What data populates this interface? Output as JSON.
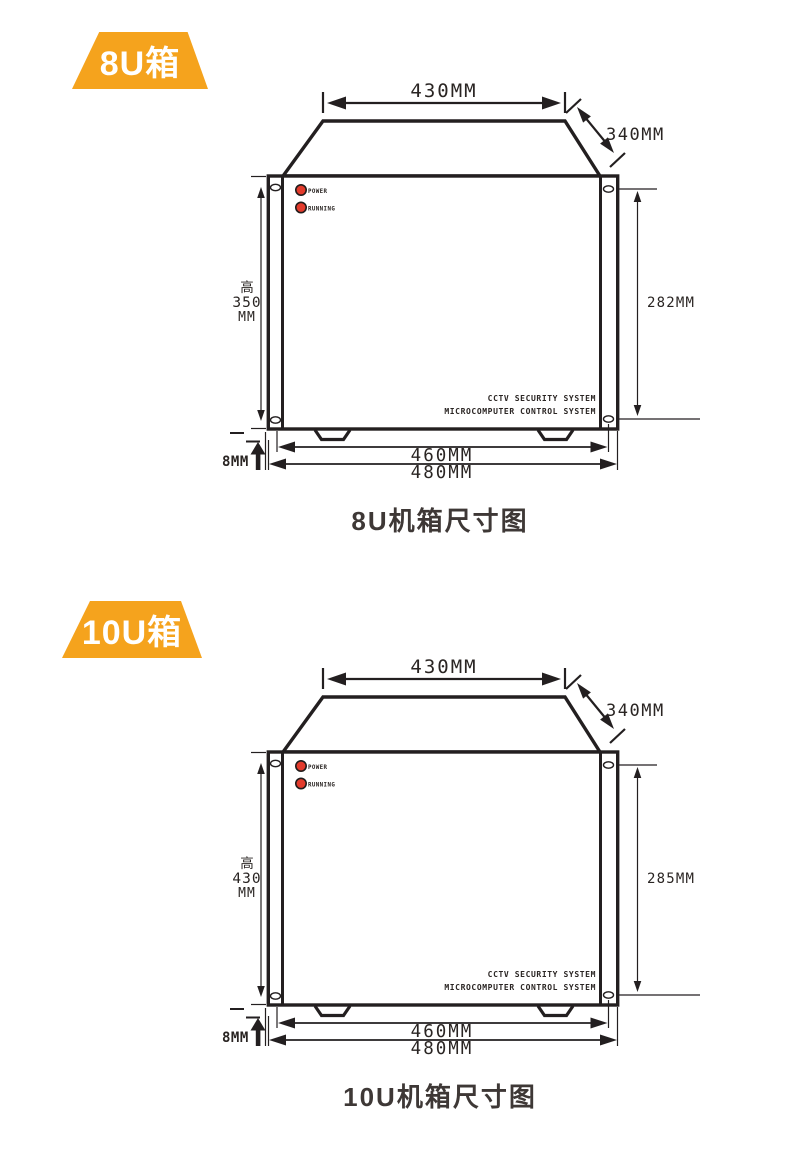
{
  "page": {
    "background": "#ffffff"
  },
  "colors": {
    "badge_bg": "#F5A31D",
    "badge_text": "#FFFFFF",
    "line": "#231F20",
    "led_red": "#E33B2C",
    "dim_text": "#2A2523",
    "caption_text": "#3E3836"
  },
  "diagrams": [
    {
      "badge": "8U箱",
      "dims": {
        "top_width": "430MM",
        "depth": "340MM",
        "height_cn": "高",
        "height_value": "350",
        "height_unit": "MM",
        "panel_height": "282MM",
        "body_width": "460MM",
        "overall_width": "480MM",
        "foot_height": "8MM"
      },
      "panel": {
        "led_power": "POWER",
        "led_running": "RUNNING",
        "brand_line1": "CCTV SECURITY SYSTEM",
        "brand_line2": "MICROCOMPUTER CONTROL SYSTEM"
      },
      "caption": "8U机箱尺寸图"
    },
    {
      "badge": "10U箱",
      "dims": {
        "top_width": "430MM",
        "depth": "340MM",
        "height_cn": "高",
        "height_value": "430",
        "height_unit": "MM",
        "panel_height": "285MM",
        "body_width": "460MM",
        "overall_width": "480MM",
        "foot_height": "8MM"
      },
      "panel": {
        "led_power": "POWER",
        "led_running": "RUNNING",
        "brand_line1": "CCTV SECURITY SYSTEM",
        "brand_line2": "MICROCOMPUTER CONTROL SYSTEM"
      },
      "caption": "10U机箱尺寸图"
    }
  ]
}
